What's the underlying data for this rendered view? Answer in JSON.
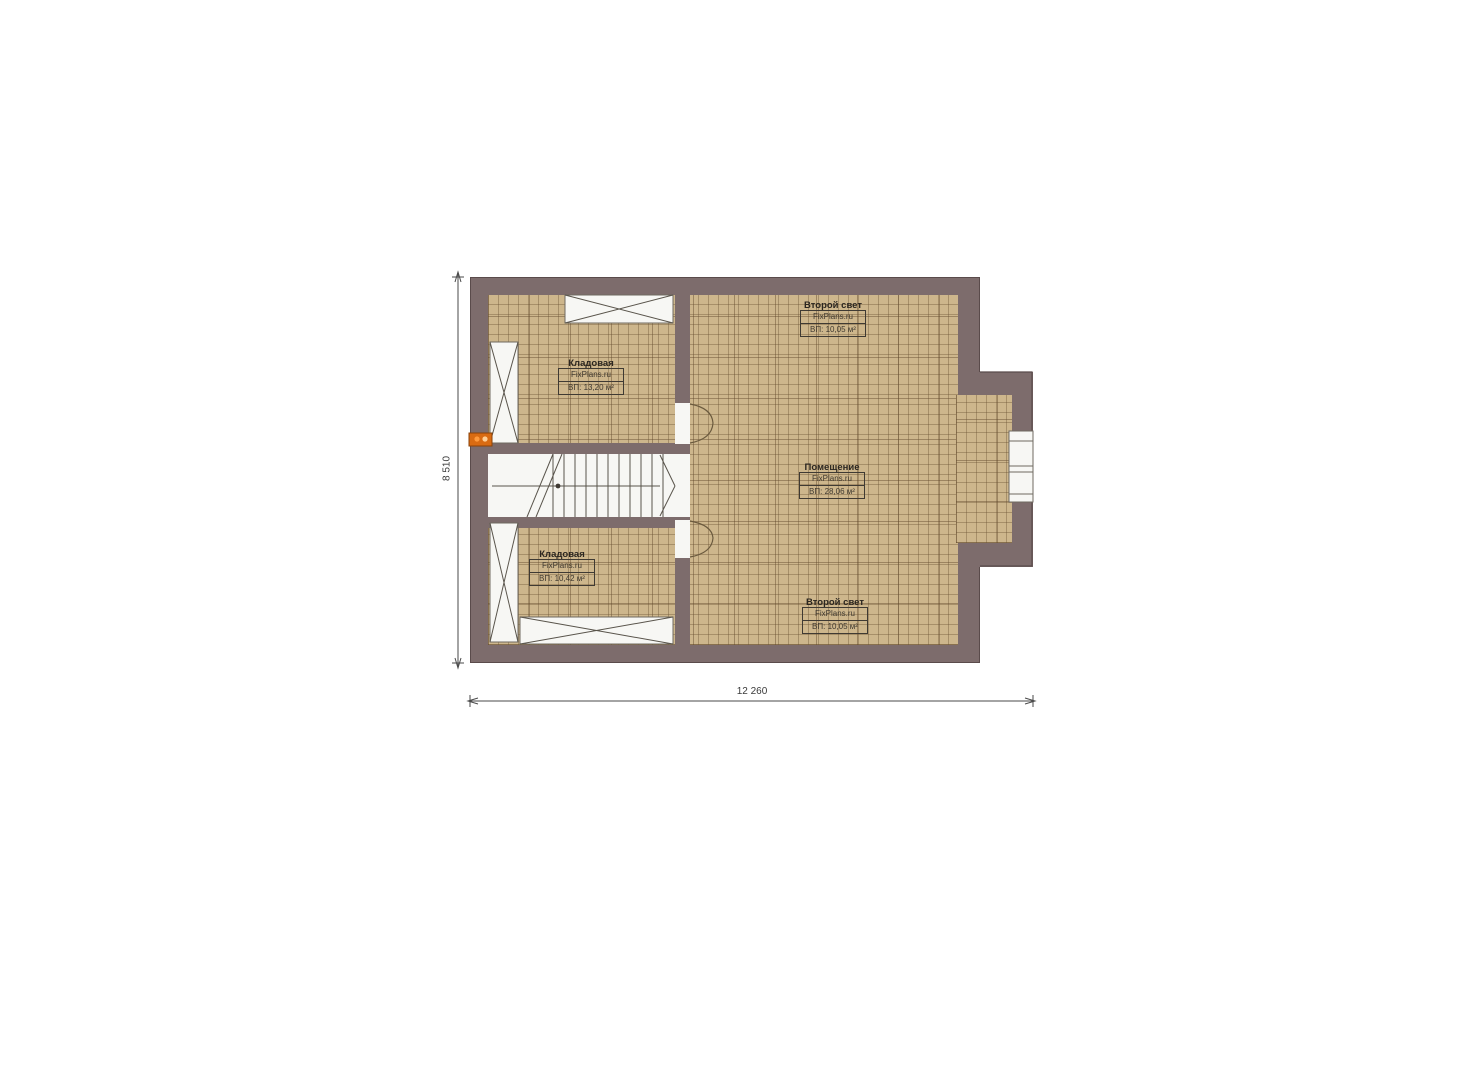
{
  "plan": {
    "type": "floor-plan",
    "rooms": [
      {
        "id": "second-light-top",
        "title": "Второй свет",
        "watermark": "FixPlans.ru",
        "area": "ВП: 10,05 м²"
      },
      {
        "id": "storage-upper",
        "title": "Кладовая",
        "watermark": "FixPlans.ru",
        "area": "ВП: 13,20 м²"
      },
      {
        "id": "main-room",
        "title": "Помещение",
        "watermark": "FixPlans.ru",
        "area": "ВП: 28,06 м²"
      },
      {
        "id": "storage-lower",
        "title": "Кладовая",
        "watermark": "FixPlans.ru",
        "area": "ВП: 10,42 м²"
      },
      {
        "id": "second-light-bottom",
        "title": "Второй свет",
        "watermark": "FixPlans.ru",
        "area": "ВП: 10,05 м²"
      }
    ],
    "dimensions": {
      "height_mm": "8 510",
      "width_mm": "12 260"
    }
  },
  "colors": {
    "wall": "#7d6c6c",
    "wall_edge": "#5a4b4b",
    "floor": "#cdb68c",
    "line": "#565249",
    "marker_orange": "#d96b12"
  }
}
